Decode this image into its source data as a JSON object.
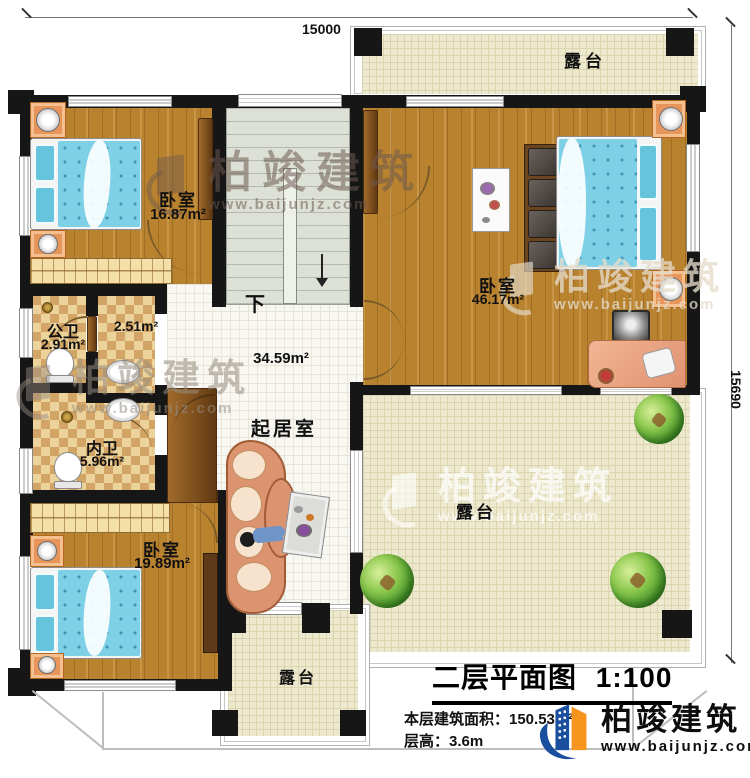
{
  "dimensions": {
    "top_width": "15000",
    "right_height": "15690"
  },
  "rooms": {
    "bedroom_top_left": {
      "name": "卧室",
      "area": "16.87m²"
    },
    "bedroom_right": {
      "name": "卧室",
      "area": "46.17m²"
    },
    "bedroom_bottom_left": {
      "name": "卧室",
      "area": "19.89m²"
    },
    "public_bathroom": {
      "name": "公卫",
      "area": "2.91m²"
    },
    "wash_area": {
      "area": "2.51m²"
    },
    "private_bathroom": {
      "name": "内卫",
      "area": "5.96m²"
    },
    "living_room": {
      "name": "起居室",
      "area": "34.59m²"
    },
    "terrace_top": {
      "name": "露台"
    },
    "terrace_right": {
      "name": "露台"
    },
    "terrace_bottom": {
      "name": "露台"
    }
  },
  "stairs": {
    "direction_label": "下"
  },
  "title_block": {
    "title": "二层平面图",
    "scale": "1:100",
    "area_label": "本层建筑面积：150.53m²",
    "floor_height_label": "层高：3.6m"
  },
  "brand": {
    "name": "柏竣建筑",
    "website": "www.baijunjz.com"
  },
  "watermark": {
    "name": "柏竣建筑",
    "website": "www.baijunjz.com"
  },
  "colors": {
    "wall": "#161616",
    "wood_floor": "#b9822e",
    "bath_tile": "#e0b97e",
    "terrace_tile": "#ede9ce",
    "living_tile": "#f8f7f2",
    "bed_blue": "#7ed0e7",
    "brand_blue": "#1a4e9e",
    "brand_orange": "#f7941d"
  }
}
